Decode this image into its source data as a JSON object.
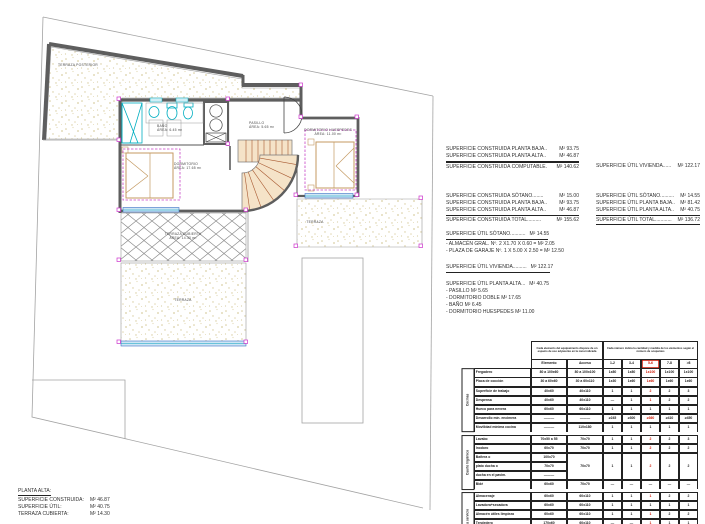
{
  "plan": {
    "terraza_posterior": "TERRAZA POSTERIOR",
    "bano_name": "BAÑO",
    "bano_area": "ÁREA: 6.45 m²",
    "dormitorio_name": "DORMITORIO",
    "dormitorio_area": "ÁREA: 17.65 m²",
    "pasillo_name": "PASILLO",
    "pasillo_area": "ÁREA: 5.65 m²",
    "huespedes_name": "DORMITORIO HUESPEDES",
    "huespedes_area": "ÁREA: 11.00 m²",
    "terraza_cubierta_name": "TERRAZA CUBIERTA",
    "terraza_cubierta_area": "ÁREA: 14.30 m²",
    "terraza_bottom": "TERRAZA",
    "terraza_right": "TERRAZA"
  },
  "summary": {
    "construida_comp": [
      {
        "label": "SUPERFICIE CONSTRUIDA PLANTA BAJA..",
        "value": "M² 93.75"
      },
      {
        "label": "SUPERFICIE CONSTRUIDA PLANTA ALTA..",
        "value": "M² 46.87"
      }
    ],
    "construida_comp_total": {
      "label": "SUPERFICIE CONSTRUIDA COMPUTABLE.",
      "value": "M² 140.62"
    },
    "util_vivienda_top": {
      "label": "SUPERFICIE ÚTIL VIVIENDA......",
      "value": "M² 122.17"
    },
    "construida_total": [
      {
        "label": "SUPERFICIE CONSTRUIDA SÓTANO........",
        "value": "M² 15.00"
      },
      {
        "label": "SUPERFICIE CONSTRUIDA PLANTA BAJA..",
        "value": "M² 93.75"
      },
      {
        "label": "SUPERFICIE CONSTRUIDA PLANTA ALTA..",
        "value": "M² 46.87"
      }
    ],
    "construida_total_sum": {
      "label": "SUPERFICIE CONSTRUIDA TOTAL..........",
      "value": "M² 155.62"
    },
    "util_total": [
      {
        "label": "SUPERFICIE ÚTIL SÓTANO..........",
        "value": "M² 14.55"
      },
      {
        "label": "SUPERFICIE ÚTIL PLANTA BAJA..",
        "value": "M² 81.42"
      },
      {
        "label": "SUPERFICIE ÚTIL PLANTA ALTA..",
        "value": "M² 40.75"
      }
    ],
    "util_total_sum": {
      "label": "SUPERFICIE ÚTIL TOTAL............",
      "value": "M² 136.72"
    },
    "util_sotano_header": {
      "label": "SUPERFICIE ÚTIL SÓTANO...........",
      "value": "M² 14.55"
    },
    "util_sotano_items": [
      "- ALMACÉN GRAL. Nº. 2 X1.70 X 0.60 =  M² 2.05",
      "- PLAZA DE GARAJE Nº.  1 X 5.00 X 2.50 =  M² 12.50"
    ],
    "util_vivienda_mid": {
      "label": "SUPERFICIE ÚTIL VIVIENDA..........",
      "value": "M² 122.17"
    },
    "util_alta_header": {
      "label": "SUPERFICIE ÚTIL PLANTA ALTA...",
      "value": "M² 40.75"
    },
    "util_alta_items": [
      "- PASILLO M² 5.65",
      "- DORMITORIO DOBLE M² 17.65",
      "- BAÑO M² 6.45",
      "- DORMITORIO HUESPEDES M² 11.00"
    ]
  },
  "footer": {
    "title": "PLANTA ALTA:",
    "rows": [
      {
        "label": "SUPERFICIE CONSTRUIDA:",
        "value": "M² 46.87"
      },
      {
        "label": "SUPERFICIE ÚTIL:",
        "value": "M² 40.75"
      },
      {
        "label": "TERRAZA CUBIERTA:",
        "value": "M² 14.30"
      }
    ]
  },
  "table": {
    "note_left": "Cada elemento del equipamiento dispone de un espacio de uso adyacente en la zona indicada",
    "note_right": "Cada número indica la cantidad y medida de los elementos según el número de ocupantes",
    "col_elemento": "Elemento",
    "col_acceso": "Acceso",
    "occupancy": [
      "1-2",
      "3-4",
      "5-6",
      "7-8",
      ">8"
    ],
    "red_color": "#cc1500",
    "sections": [
      {
        "label": "Cocinas",
        "rows": [
          {
            "name": "Fregadero",
            "dim": "80 a 100x60",
            "acc": "80 a 100x100",
            "counts": [
              "1x80",
              "1x80",
              "1x100",
              "1x100",
              "1x100"
            ],
            "red": true
          },
          {
            "name": "Placa de cocción",
            "dim": "30 a 60x60",
            "acc": "30 a 60x110",
            "counts": [
              "1x30",
              "1x60",
              "1x60",
              "1x60",
              "1x60"
            ],
            "red": true
          },
          {
            "name": "Superficie de trabajo",
            "dim": "40x60",
            "acc": "40x110",
            "counts": [
              "1",
              "1",
              "2",
              "2",
              "3"
            ],
            "red": true
          },
          {
            "name": "Despensa",
            "dim": "40x60",
            "acc": "40x110",
            "counts": [
              "—",
              "1",
              "1",
              "2",
              "2"
            ],
            "red": true
          },
          {
            "name": "Hueco para nevera",
            "dim": "60x60",
            "acc": "60x110",
            "counts": [
              "1",
              "1",
              "1",
              "1",
              "1"
            ],
            "red": false
          },
          {
            "name": "Desarrollo mín. encimera",
            "dim": "———",
            "acc": "———",
            "counts": [
              "≥245",
              "≥300",
              "≥360",
              "≥410",
              "≥450"
            ],
            "red": true
          },
          {
            "name": "Movilidad mínima cocina",
            "dim": "———",
            "acc": "110x180",
            "counts": [
              "1",
              "1",
              "1",
              "1",
              "1"
            ],
            "red": false
          }
        ]
      },
      {
        "label": "Cuarto higiénico",
        "rows": [
          {
            "name": "Lavabo",
            "dim": "70x50 a 55",
            "acc": "70x70",
            "counts": [
              "1",
              "1",
              "2",
              "2",
              "3"
            ],
            "red": true
          },
          {
            "name": "Inodoro",
            "dim": "60x70",
            "acc": "70x70",
            "counts": [
              "1",
              "1",
              "2",
              "2",
              "2"
            ],
            "red": true
          },
          {
            "group": [
              "Bañera o",
              "plato ducha o",
              "ducha en el pavim."
            ],
            "dims": [
              "100x70",
              "70x70",
              "———"
            ],
            "acc": "70x70",
            "counts": [
              "1",
              "1",
              "2",
              "2",
              "2"
            ],
            "red": true
          },
          {
            "name": "Bidé",
            "dim": "60x60",
            "acc": "70x70",
            "counts": [
              "—",
              "—",
              "—",
              "—",
              "—"
            ],
            "red": false
          }
        ]
      },
      {
        "label": "Pieza servicio",
        "rows": [
          {
            "name": "Almacenaje",
            "dim": "60x60",
            "acc": "60x110",
            "counts": [
              "1",
              "1",
              "1",
              "2",
              "2"
            ],
            "red": true
          },
          {
            "name": "Lavadora+secadora",
            "dim": "60x60",
            "acc": "60x110",
            "counts": [
              "1",
              "1",
              "1",
              "1",
              "1"
            ],
            "red": false
          },
          {
            "name": "Almacén útiles limpieza",
            "dim": "60x60",
            "acc": "60x110",
            "counts": [
              "1",
              "1",
              "1",
              "2",
              "2"
            ],
            "red": true
          },
          {
            "name": "Tendedero",
            "dim": "170x60",
            "acc": "60x110",
            "counts": [
              "—",
              "—",
              "1",
              "1",
              "1"
            ],
            "red": true
          },
          {
            "name": "Vertedero",
            "dim": "50x70",
            "acc": "60x110",
            "counts": [
              "—",
              "—",
              "—",
              "—",
              "—"
            ],
            "red": false
          },
          {
            "name": "Almacén gral. (trastero)",
            "dim": "170x60",
            "acc": "———",
            "counts": [
              "2",
              "2",
              "2",
              "3",
              "4"
            ],
            "red": true
          }
        ]
      }
    ]
  }
}
